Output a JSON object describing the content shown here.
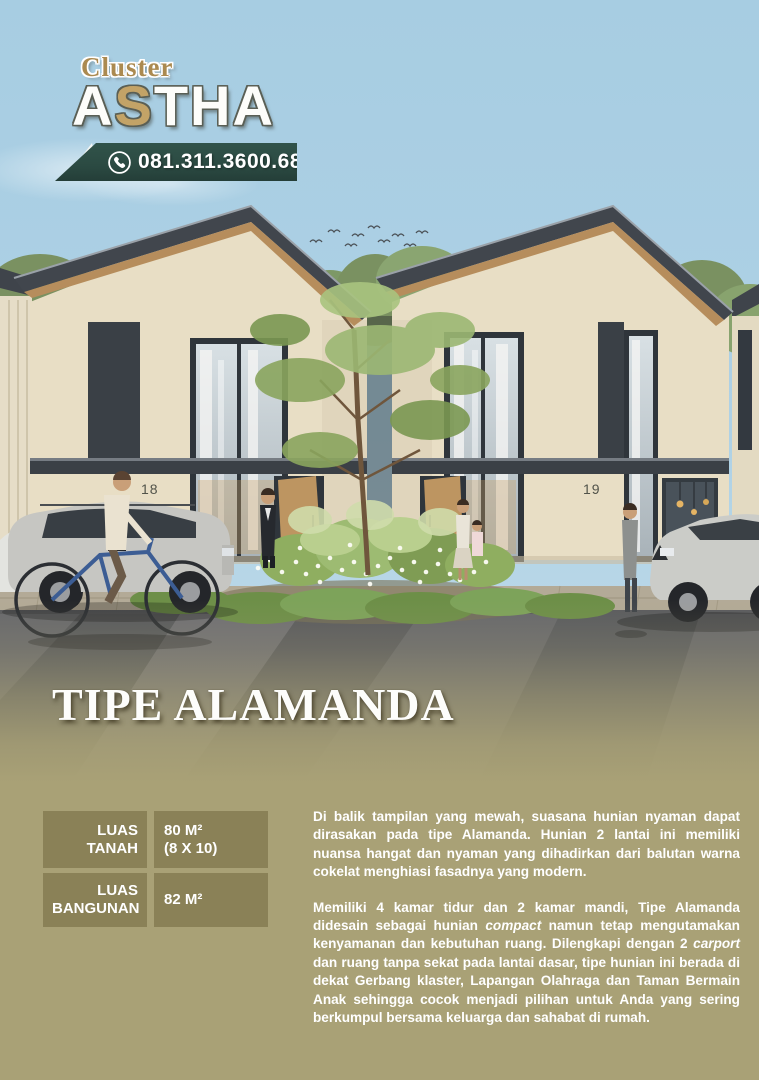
{
  "logo": {
    "prefix": "Cluster",
    "astha_a1": "A",
    "astha_s": "S",
    "astha_rest": "THA"
  },
  "contact": {
    "phone": "081.311.3600.68",
    "icon": "phone-icon"
  },
  "scene": {
    "house_numbers": [
      "18",
      "19"
    ]
  },
  "title": "TIPE ALAMANDA",
  "specs": {
    "rows": [
      {
        "label": "LUAS TANAH",
        "value": "80 M²",
        "value2": "(8 X 10)"
      },
      {
        "label": "LUAS BANGUNAN",
        "value": "82 M²",
        "value2": ""
      }
    ]
  },
  "paragraphs": [
    {
      "segments": [
        {
          "text": "Di balik tampilan yang mewah, suasana hunian nyaman dapat dirasakan pada tipe Alamanda. Hunian 2 lantai ini memiliki nuansa hangat dan nyaman yang dihadirkan dari balutan warna cokelat menghiasi fasadnya yang modern.",
          "italic": false
        }
      ]
    },
    {
      "segments": [
        {
          "text": "Memiliki 4 kamar tidur dan 2 kamar mandi, Tipe Alamanda didesain sebagai hunian ",
          "italic": false
        },
        {
          "text": "compact",
          "italic": true
        },
        {
          "text": " namun tetap mengutamakan kenyamanan dan kebutuhan ruang. Dilengkapi dengan 2 ",
          "italic": false
        },
        {
          "text": "carport",
          "italic": true
        },
        {
          "text": " dan ruang tanpa sekat pada lantai dasar, tipe hunian ini berada di dekat Gerbang klaster, Lapangan Olahraga dan Taman Bermain Anak sehingga cocok menjadi pilihan untuk Anda yang sering berkumpul bersama keluarga dan sahabat di rumah.",
          "italic": false
        }
      ]
    }
  ],
  "colors": {
    "sky": "#a7cde2",
    "banner_green": "#2b4a42",
    "bottom_khaki": "#a9a176",
    "spec_cell_olive": "#8a8157",
    "logo_gold": "#ab8a50",
    "astha_s_gold": "#c3a367",
    "roof_dark": "#41464d",
    "wall_cream": "#e8dec5"
  }
}
